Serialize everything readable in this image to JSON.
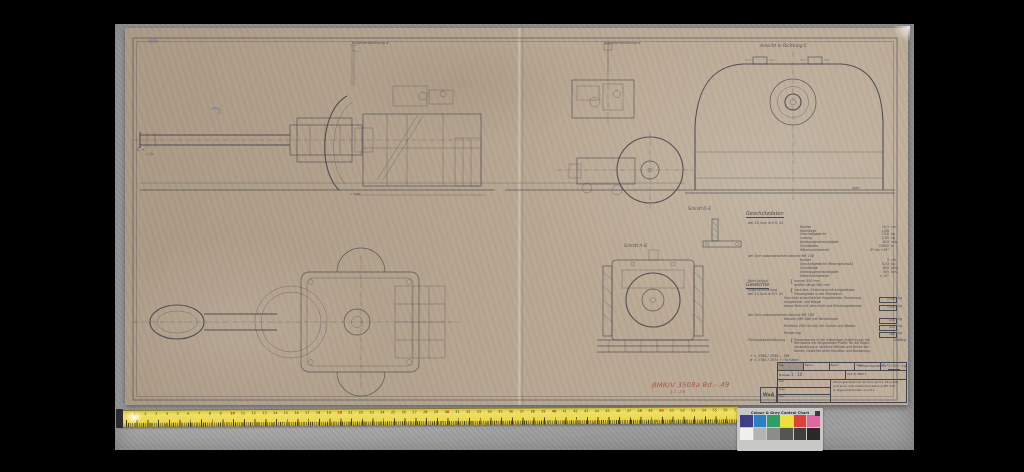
{
  "drawing_labels": {
    "view_a": "Kugelverankerung a",
    "view_b": "Kugelverankerung b",
    "view_c": "Ansicht in Richtung C",
    "schnitt_de": "Schnitt D–E",
    "schnitt_ab": "Schnitt A–B",
    "direction_c": "C →",
    "dim_view1": "≈ 4790",
    "dim_view4": "4936"
  },
  "specs": {
    "title": "Geschützdaten",
    "sub1": "der 10,5cm le.F.H. 43",
    "rows1": [
      {
        "label": "Kaliber",
        "value": "10,5",
        "unit": "cm"
      },
      {
        "label": "Rohrlänge",
        "value": "L/28",
        "unit": ""
      },
      {
        "label": "Geschoßgewicht",
        "value": "14,8",
        "unit": "kg"
      },
      {
        "label": "Ladung",
        "value": "2,85",
        "unit": "kg"
      },
      {
        "label": "Anfangsgeschwindigkeit",
        "value": "610",
        "unit": "m/s"
      },
      {
        "label": "Schußweite",
        "value": "15000",
        "unit": "m"
      },
      {
        "label": "Höhenrichtbereich",
        "value": "-8° bis +45°",
        "unit": ""
      }
    ],
    "sub2": "der 3cm automatischen Kanone MK 108",
    "rows2": [
      {
        "label": "Kaliber",
        "value": "3",
        "unit": "cm"
      },
      {
        "label": "Geschoßgewicht (Minengeschoß)",
        "value": "0,33",
        "unit": "kg"
      },
      {
        "label": "Schußfolge",
        "value": "600",
        "unit": "/min"
      },
      {
        "label": "Anfangsgeschwindigkeit",
        "value": "505",
        "unit": "m/s"
      },
      {
        "label": "Höhenrichtbereich",
        "value": "± 10°",
        "unit": ""
      }
    ],
    "note1_label": "Rohrrücklauf",
    "note1_line1": "normal 550 mm",
    "note1_line2": "größte Länge 580 mm",
    "note2_label": "Kugelverankerung",
    "note2_line1": "nach bes. Zeichnung mit eingesetzter",
    "note2_line2": "Panzerplatte in der Stirnwand"
  },
  "weights": {
    "title": "Gewichte",
    "sub1": "der 10,5cm le.F.H. 43",
    "row1a_label": "Geschütz einschließlich Kugelblende, Panzerung,",
    "row1a_label2": "Ausgleicher und Wiege",
    "row1a_value": "2750",
    "row1a_unit": "kg",
    "row1b_label": "davon Rohr mit Verschluß und Mündungsbremse",
    "row1b_value": "1150",
    "row1b_unit": "kg",
    "sub2": "der 3cm automatischen Kanone MK 108",
    "row2a_label": "Kanone (MK 108) mit Panzerkugel",
    "row2a_value": "400",
    "row2a_unit": "kg",
    "row2b_label": "Munition (500 Schuß) mit Gurten und Kästen",
    "row2b_value": "251",
    "row2b_unit": "kg",
    "row2c_label": "Panzerung",
    "row2c_value": "280",
    "row2c_unit": "kg",
    "note_label": "Führungsbeschädigung",
    "note_line1": "Panzerwanne in der bisherigen Ausführung; die",
    "note_line2": "Stirnwand mit eingesetzter Platte für die Kugel-",
    "note_line3": "verankerung a; seitliche Wände und Decke wie",
    "note_line4": "bisher; Gewichte ohne Munition und Besatzung.",
    "note_value": "2086",
    "note_unit": "kg",
    "footnote1": "+ = 2788 / 2938 — DM",
    "footnote2": "# = 2784 / 2874 + für Kabel",
    "total_label": "Gesamtgewicht",
    "total_value": "27500",
    "total_unit": "kg"
  },
  "titleblock": {
    "stamp": "WaA",
    "f1": "Tag",
    "f2": "Name",
    "f3": "Bearb.",
    "f4": "Gepr.",
    "scale_label": "Maßstab",
    "scale": "1 : 10",
    "g1": "Gez.",
    "g2": "Gepr.",
    "g3": "Ges.",
    "number": "021 B 38677",
    "sheet_no": "Bl. 1",
    "title_line1": "Sturmgeschütz mit 10,5cm le.F.H. 43 (L/28)",
    "title_line2": "und einer automatischen Kanone MK 108",
    "title_line3": "in Kugelvollblenden a und b"
  },
  "red_note": {
    "line1": "BMR/V 3508a Bd.–.49",
    "line2": "13.26"
  },
  "color_chart": {
    "title": "Colour & Grey Control Chart",
    "row1": [
      "#3f3f85",
      "#2d7fc4",
      "#2f9e68",
      "#efdf3d",
      "#dd4238",
      "#e0679f"
    ],
    "row2": [
      "#f2f0ea",
      "#b3b3b1",
      "#8c8c8a",
      "#555553",
      "#3f3e3c",
      "#2a2928"
    ]
  },
  "ruler": {
    "count": 57,
    "red_every": 10
  }
}
